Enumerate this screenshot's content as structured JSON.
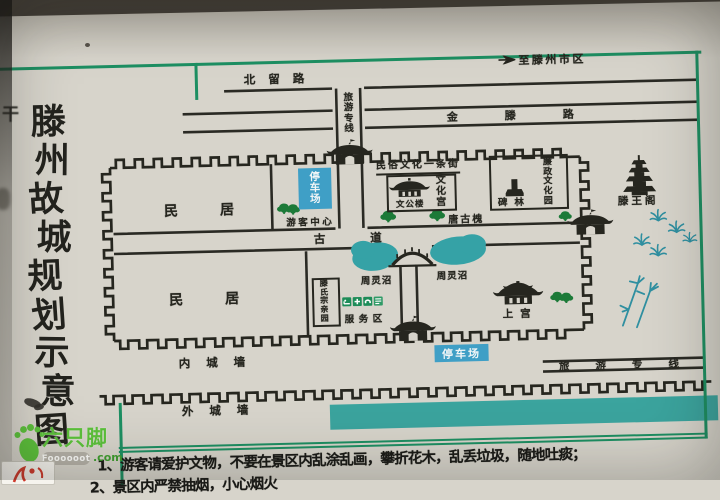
{
  "map": {
    "title": "滕州故城规划示意图",
    "roads": {
      "beiliu": "北留路",
      "to_city": "至滕州市区",
      "jinteng": "金滕路",
      "tourist_line_top": "旅游专线",
      "ancient_road": "古道",
      "tourist_line_bottom": "旅游专线"
    },
    "labels": {
      "residence": "民居",
      "parking": "停车场",
      "visitor_center": "游客中心",
      "folk_culture_street": "民俗文化一条街",
      "wengong_tower": "文公楼",
      "culture_palace": "文化宫",
      "tang_ancient_locust": "唐古槐",
      "stele_forest": "碑林",
      "integrity_culture_park": "廉政文化园",
      "tengwang_pavilion": "滕王阁",
      "zhouling_pond": "周灵沼",
      "teng_clan_garden": "滕氏宗亲园",
      "service_area": "服务区",
      "shang_palace": "上宫",
      "inner_city_wall": "内城墙",
      "outer_city_wall": "外城墙"
    },
    "notice_lines": [
      "1、游客请爱护文物，不要在景区内乱涂乱画，攀折花木，乱丢垃圾，随地吐痰；",
      "2、景区内严禁抽烟，小心烟火"
    ],
    "edge_partial_text": "干"
  },
  "watermark": {
    "brand": "六只脚",
    "name": "Foooooot",
    "tld": ".com"
  },
  "colors": {
    "frame_green": "#1d8f62",
    "water_teal": "#35a2a6",
    "parking_blue": "#3f9fc6",
    "tree_green": "#1c7a38",
    "ink": "#26261f",
    "watermark_green": "#5cc13b"
  }
}
